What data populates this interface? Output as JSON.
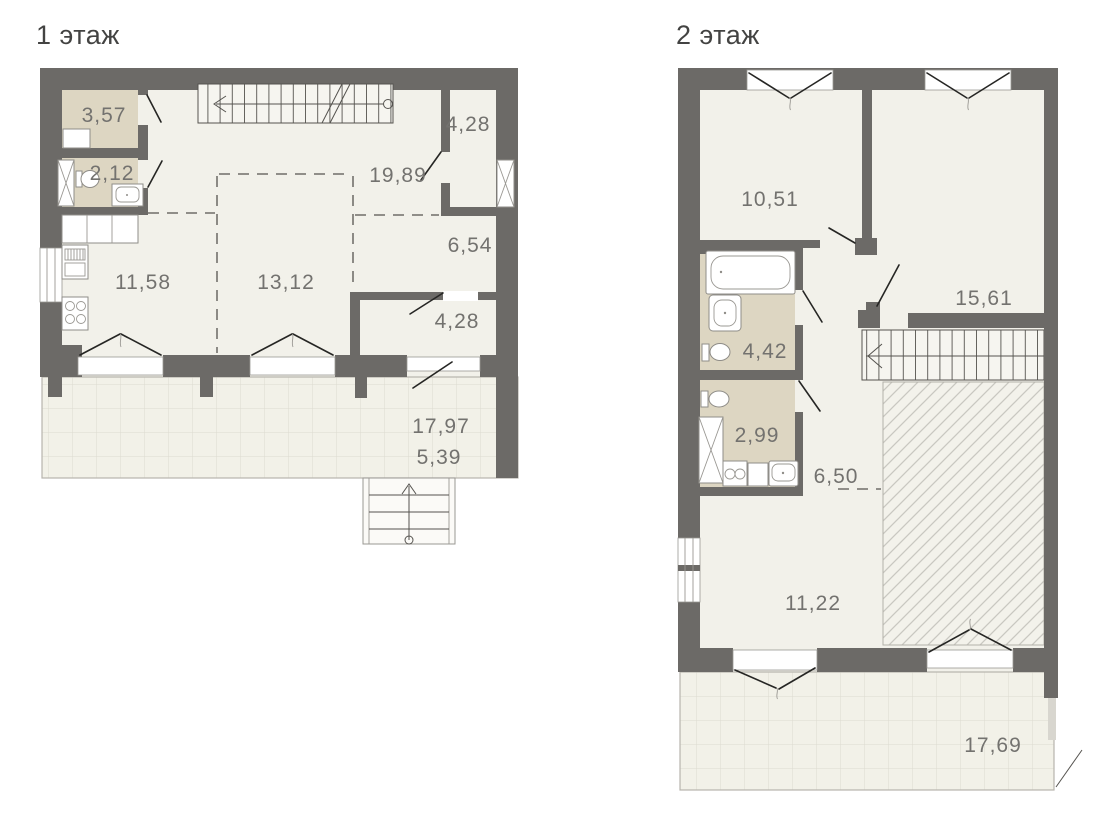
{
  "floor1": {
    "title": "1 этаж",
    "labels": {
      "room_3_57": "3,57",
      "room_2_12": "2,12",
      "room_19_89": "19,89",
      "room_4_28_top": "4,28",
      "room_6_54": "6,54",
      "room_11_58": "11,58",
      "room_13_12": "13,12",
      "room_4_28_low": "4,28",
      "terrace_line1": "17,97",
      "terrace_line2": "5,39"
    }
  },
  "floor2": {
    "title": "2 этаж",
    "labels": {
      "room_10_51": "10,51",
      "room_15_61": "15,61",
      "room_4_42": "4,42",
      "room_2_99": "2,99",
      "room_6_50": "6,50",
      "room_11_22": "11,22",
      "terrace": "17,69"
    }
  },
  "colors": {
    "wall": "#6c6a67",
    "room_fill": "#f2f1ea",
    "wet_room_fill": "#ddd6c2",
    "terrace_fill": "#f2f1e8",
    "terrace_grid_line": "#dcdad0",
    "hatch_line": "#c9c8c1",
    "symbol_line": "#262624",
    "label_text": "#73726f",
    "title_text": "#434342"
  }
}
